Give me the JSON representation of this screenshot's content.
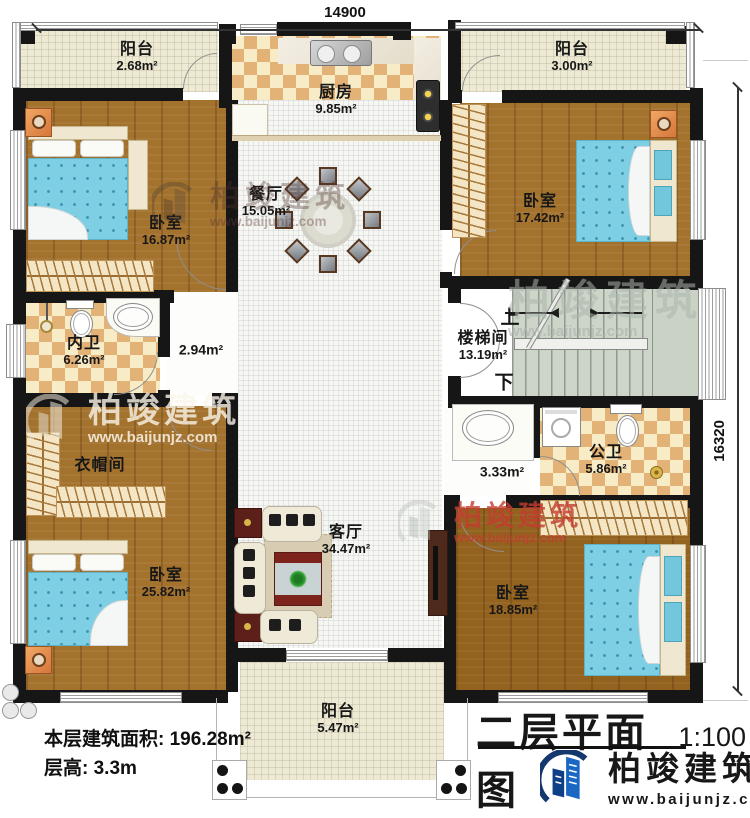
{
  "plan": {
    "title": "二层平面图",
    "scale": "1:100",
    "area_label": "本层建筑面积:",
    "area_value": "196.28m²",
    "height_label": "层高:",
    "height_value": "3.3m",
    "dim_width": "14900",
    "dim_height": "16320"
  },
  "rooms": {
    "balcony_tl": {
      "name": "阳台",
      "area": "2.68m²"
    },
    "kitchen": {
      "name": "厨房",
      "area": "9.85m²"
    },
    "balcony_tr": {
      "name": "阳台",
      "area": "3.00m²"
    },
    "dining": {
      "name": "餐厅",
      "area": "15.05m²"
    },
    "bedroom_tl": {
      "name": "卧室",
      "area": "16.87m²"
    },
    "bedroom_tr": {
      "name": "卧室",
      "area": "17.42m²"
    },
    "bath_ensuite": {
      "name": "内卫",
      "area": "6.26m²"
    },
    "hall_upper": {
      "area": "2.94m²"
    },
    "stairwell": {
      "name": "楼梯间",
      "area": "13.19m²",
      "up": "上",
      "down": "下"
    },
    "cloakroom": {
      "name": "衣帽间"
    },
    "hall_lower": {
      "area": "3.33m²"
    },
    "bath_public": {
      "name": "公卫",
      "area": "5.86m²"
    },
    "bedroom_bl": {
      "name": "卧室",
      "area": "25.82m²"
    },
    "living": {
      "name": "客厅",
      "area": "34.47m²"
    },
    "bedroom_br": {
      "name": "卧室",
      "area": "18.85m²"
    },
    "balcony_bottom": {
      "name": "阳台",
      "area": "5.47m²"
    }
  },
  "brand": {
    "name": "柏竣建筑",
    "website": "www.baijunjz.com"
  },
  "colors": {
    "wall": "#161616",
    "wood": "#a3722d",
    "tile": "#e2b277",
    "brand_blue": "#1b67c4",
    "watermark_red": "#c23c30"
  }
}
